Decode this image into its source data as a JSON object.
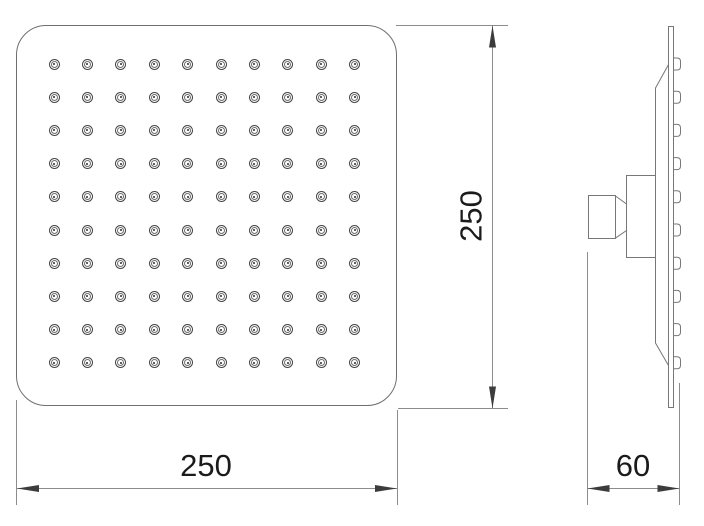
{
  "dimensions": {
    "front_width": {
      "label": "250"
    },
    "front_height": {
      "label": "250"
    },
    "side_depth": {
      "label": "60"
    }
  },
  "front_view": {
    "nozzle_grid": {
      "rows": 10,
      "cols": 10
    }
  },
  "side_view": {
    "nozzle_count": 10
  },
  "colors": {
    "background": "#ffffff",
    "part_line": "#777777",
    "dimension_line": "#8c8c8c",
    "arrow": "#3c3c3c",
    "text": "#1b1b1b"
  }
}
